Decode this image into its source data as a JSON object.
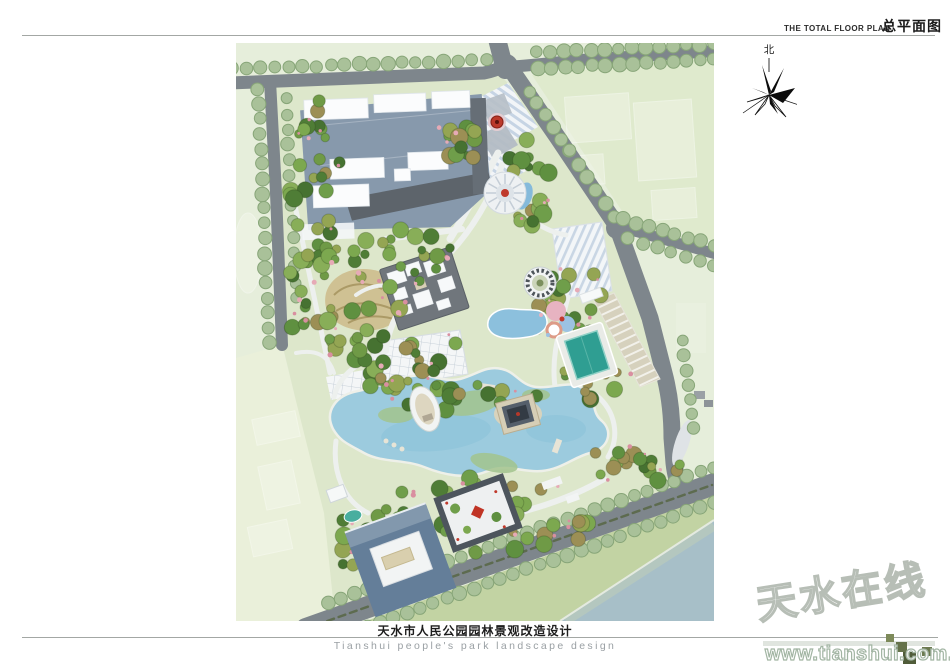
{
  "header": {
    "title_en": "THE TOTAL FLOOR PLAN",
    "title_zh": "总平面图"
  },
  "north_arrow": {
    "label": "北"
  },
  "footer": {
    "title_zh": "天水市人民公园园林景观改造设计",
    "title_en": "Tianshui people's park landscape design"
  },
  "watermark": {
    "site_name": "天水在线",
    "url": "www.tianshui.com.cn"
  },
  "colors": {
    "page_bg": "#ffffff",
    "field_green": "#e6eedb",
    "road_gray": "#7e868c",
    "street_tree_green": "#a9c199",
    "lake_blue": "#9ccbde",
    "pool_teal": "#2f9e92",
    "river_blue": "#a7bfc8",
    "building_roof_white": "#fbfcfd",
    "building_shadow_blue": "#8799ac",
    "accent_red": "#bb392b"
  }
}
